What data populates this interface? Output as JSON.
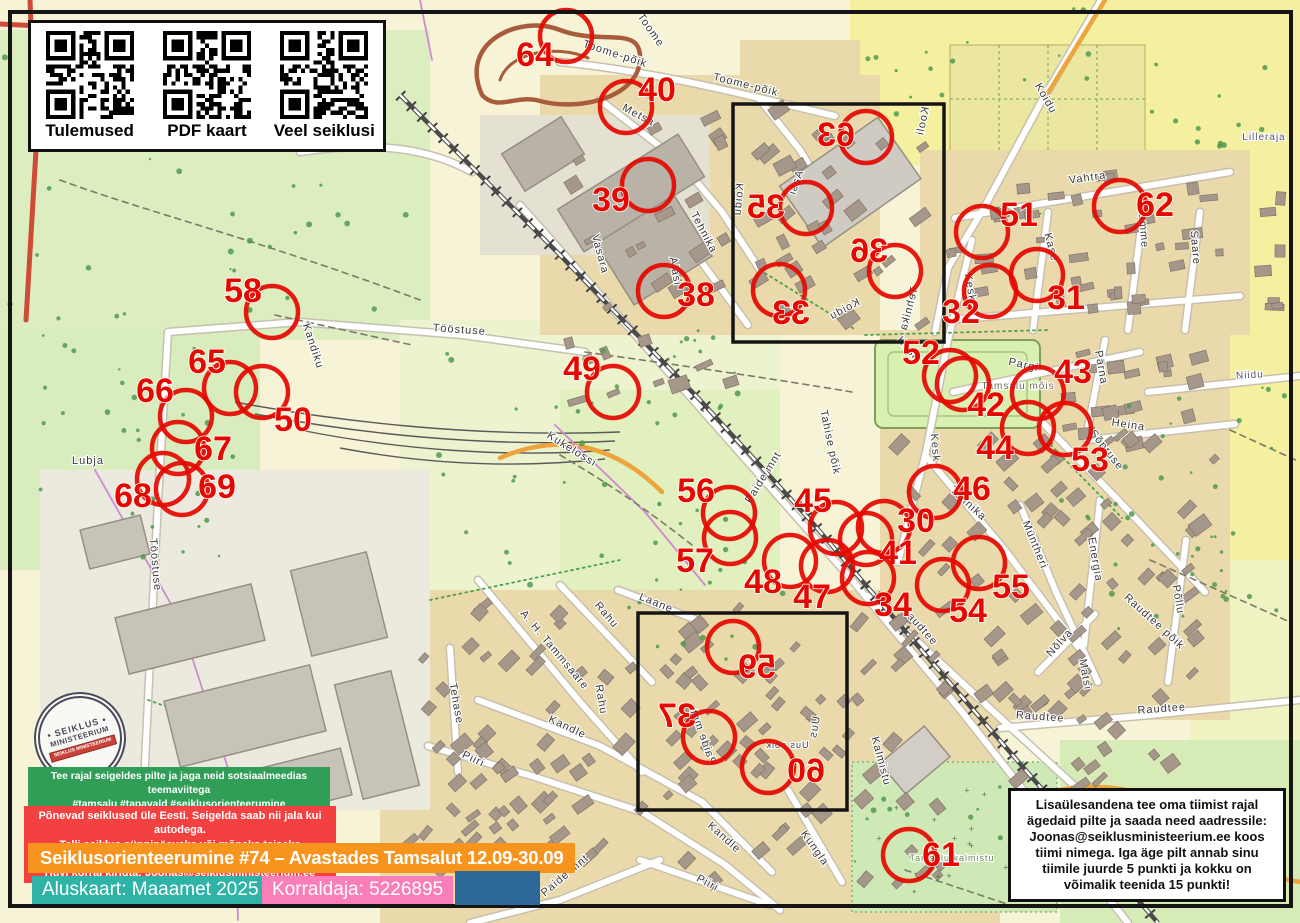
{
  "qr_panel": {
    "items": [
      {
        "label": "Tulemused",
        "color": "#56c462"
      },
      {
        "label": "PDF kaart",
        "color": "#f23d20"
      },
      {
        "label": "Veel seiklusi",
        "color": "#1d6fb8"
      }
    ]
  },
  "stamp": {
    "line1": "• SEIKLUS •",
    "line2": "MINISTEERIUM",
    "line3": "SEIKLUS MINISTEERIUM"
  },
  "social_box": {
    "line1": "Tee rajal seigeldes pilte ja jaga neid sotsiaalmeedias teemaviitega",
    "line2": "#tamsalu #tapavald #seiklusorienteerumine #seiklusministeerium"
  },
  "promo_box": {
    "line1": "Põnevad seiklused üle Eesti. Seigelda saab nii jala kui autodega.",
    "line2": "Telli seiklus sünnipäevaks või mõneks teiseks tähtpäevaks!",
    "line3": "Huvi korral kirjuta: Joonas@seiklusministeerium.ee"
  },
  "title_bar": "Seiklusorienteerumine #74 – Avastades Tamsalut 12.09-30.09",
  "base_bar": "Aluskaart: Maaamet 2025",
  "org_bar": "Korraldaja: 5226895",
  "note_box": "Lisaülesandena tee oma tiimist rajal ägedaid pilte ja saada need aadressile: Joonas@seiklusministeerium.ee koos tiimi nimega. Iga äge pilt annab sinu tiimile juurde 5 punkti ja kokku on võimalik teenida 15 punkti!",
  "map": {
    "control_color": "#e50800",
    "controls": [
      {
        "n": "64",
        "x": 566,
        "y": 36,
        "lx": 535,
        "ly": 57
      },
      {
        "n": "40",
        "x": 626,
        "y": 107,
        "lx": 657,
        "ly": 92
      },
      {
        "n": "39",
        "x": 648,
        "y": 185,
        "lx": 611,
        "ly": 202
      },
      {
        "n": "63",
        "x": 866,
        "y": 137,
        "lx": 836,
        "ly": 137,
        "m": 1
      },
      {
        "n": "35",
        "x": 806,
        "y": 208,
        "lx": 766,
        "ly": 209,
        "m": 1
      },
      {
        "n": "36",
        "x": 895,
        "y": 271,
        "lx": 869,
        "ly": 253,
        "m": 1
      },
      {
        "n": "33",
        "x": 779,
        "y": 290,
        "lx": 791,
        "ly": 315,
        "m": 1
      },
      {
        "n": "51",
        "x": 982,
        "y": 232,
        "lx": 1019,
        "ly": 217
      },
      {
        "n": "62",
        "x": 1120,
        "y": 206,
        "lx": 1155,
        "ly": 207
      },
      {
        "n": "58",
        "x": 272,
        "y": 312,
        "lx": 243,
        "ly": 293
      },
      {
        "n": "38",
        "x": 664,
        "y": 291,
        "lx": 696,
        "ly": 297
      },
      {
        "n": "32",
        "x": 990,
        "y": 291,
        "lx": 961,
        "ly": 314
      },
      {
        "n": "31",
        "x": 1037,
        "y": 275,
        "lx": 1066,
        "ly": 300
      },
      {
        "n": "65",
        "x": 230,
        "y": 388,
        "lx": 207,
        "ly": 364
      },
      {
        "n": "50",
        "x": 262,
        "y": 392,
        "lx": 293,
        "ly": 422
      },
      {
        "n": "66",
        "x": 186,
        "y": 416,
        "lx": 155,
        "ly": 393
      },
      {
        "n": "67",
        "x": 178,
        "y": 448,
        "lx": 213,
        "ly": 451
      },
      {
        "n": "68",
        "x": 163,
        "y": 479,
        "lx": 133,
        "ly": 498
      },
      {
        "n": "69",
        "x": 182,
        "y": 489,
        "lx": 217,
        "ly": 489
      },
      {
        "n": "49",
        "x": 613,
        "y": 392,
        "lx": 582,
        "ly": 371
      },
      {
        "n": "52",
        "x": 950,
        "y": 376,
        "lx": 921,
        "ly": 355
      },
      {
        "n": "42",
        "x": 963,
        "y": 384,
        "lx": 986,
        "ly": 407
      },
      {
        "n": "43",
        "x": 1038,
        "y": 393,
        "lx": 1073,
        "ly": 374
      },
      {
        "n": "44",
        "x": 1028,
        "y": 428,
        "lx": 995,
        "ly": 450
      },
      {
        "n": "53",
        "x": 1065,
        "y": 429,
        "lx": 1090,
        "ly": 462
      },
      {
        "n": "46",
        "x": 935,
        "y": 492,
        "lx": 972,
        "ly": 491
      },
      {
        "n": "56",
        "x": 729,
        "y": 513,
        "lx": 696,
        "ly": 493
      },
      {
        "n": "57",
        "x": 730,
        "y": 538,
        "lx": 695,
        "ly": 563
      },
      {
        "n": "45",
        "x": 836,
        "y": 528,
        "lx": 813,
        "ly": 503
      },
      {
        "n": "30",
        "x": 884,
        "y": 527,
        "lx": 916,
        "ly": 523
      },
      {
        "n": "41",
        "x": 866,
        "y": 539,
        "lx": 898,
        "ly": 555
      },
      {
        "n": "48",
        "x": 790,
        "y": 561,
        "lx": 763,
        "ly": 584
      },
      {
        "n": "47",
        "x": 827,
        "y": 566,
        "lx": 812,
        "ly": 599
      },
      {
        "n": "34",
        "x": 868,
        "y": 578,
        "lx": 893,
        "ly": 607
      },
      {
        "n": "55",
        "x": 979,
        "y": 563,
        "lx": 1011,
        "ly": 589
      },
      {
        "n": "54",
        "x": 943,
        "y": 585,
        "lx": 968,
        "ly": 613
      },
      {
        "n": "59",
        "x": 733,
        "y": 647,
        "lx": 757,
        "ly": 669,
        "m": 1
      },
      {
        "n": "37",
        "x": 709,
        "y": 737,
        "lx": 677,
        "ly": 718,
        "m": 1
      },
      {
        "n": "60",
        "x": 768,
        "y": 767,
        "lx": 806,
        "ly": 773,
        "m": 1
      },
      {
        "n": "61",
        "x": 909,
        "y": 855,
        "lx": 941,
        "ly": 857
      }
    ],
    "street_labels": [
      {
        "t": "Toome",
        "x": 648,
        "y": 32,
        "r": 55
      },
      {
        "t": "Toome-põik",
        "x": 614,
        "y": 57,
        "r": 18
      },
      {
        "t": "Toome-põik",
        "x": 745,
        "y": 88,
        "r": 14
      },
      {
        "t": "Metsa",
        "x": 637,
        "y": 118,
        "r": 28
      },
      {
        "t": "Tehnika",
        "x": 701,
        "y": 234,
        "r": 62
      },
      {
        "t": "Vasara",
        "x": 597,
        "y": 255,
        "r": 75
      },
      {
        "t": "Alasi",
        "x": 672,
        "y": 272,
        "r": 80
      },
      {
        "t": "Koidu",
        "x": 1043,
        "y": 100,
        "r": 60
      },
      {
        "t": "Vahtra",
        "x": 1088,
        "y": 181,
        "r": -8
      },
      {
        "t": "Kase",
        "x": 1048,
        "y": 248,
        "r": 75
      },
      {
        "t": "Tamme",
        "x": 1140,
        "y": 228,
        "r": 85
      },
      {
        "t": "Saare",
        "x": 1192,
        "y": 248,
        "r": 85
      },
      {
        "t": "Lilleraja",
        "x": 1264,
        "y": 140,
        "r": 0,
        "s": 10,
        "c": "#555577"
      },
      {
        "t": "Kooli",
        "x": 926,
        "y": 122,
        "r": 78,
        "m": 1
      },
      {
        "t": "Aasi",
        "x": 799,
        "y": 184,
        "r": 70,
        "m": 1
      },
      {
        "t": "Koidu",
        "x": 742,
        "y": 200,
        "r": 85,
        "m": 1
      },
      {
        "t": "Koidu",
        "x": 846,
        "y": 312,
        "r": 28,
        "m": 1
      },
      {
        "t": "Tehnika",
        "x": 912,
        "y": 310,
        "r": 75,
        "m": 1
      },
      {
        "t": "Kesk",
        "x": 967,
        "y": 288,
        "r": 80
      },
      {
        "t": "Kesk",
        "x": 906,
        "y": 351,
        "r": 48
      },
      {
        "t": "Kesk",
        "x": 932,
        "y": 448,
        "r": 85
      },
      {
        "t": "Pargi",
        "x": 1023,
        "y": 368,
        "r": 12
      },
      {
        "t": "Tamsalu mõis",
        "x": 1018,
        "y": 389,
        "r": 0,
        "s": 10,
        "c": "#6b6b5a"
      },
      {
        "t": "Pärna",
        "x": 1098,
        "y": 368,
        "r": 80
      },
      {
        "t": "Heina",
        "x": 1128,
        "y": 428,
        "r": 8
      },
      {
        "t": "Sõpruse",
        "x": 1104,
        "y": 452,
        "r": 52
      },
      {
        "t": "Niidu",
        "x": 1250,
        "y": 378,
        "r": -3,
        "s": 10,
        "c": "#555577"
      },
      {
        "t": "Tahise põik",
        "x": 827,
        "y": 443,
        "r": 78
      },
      {
        "t": "Tehnika",
        "x": 966,
        "y": 506,
        "r": 42
      },
      {
        "t": "Müntheri",
        "x": 1032,
        "y": 546,
        "r": 68
      },
      {
        "t": "Energia",
        "x": 1092,
        "y": 560,
        "r": 80
      },
      {
        "t": "Põllu",
        "x": 1175,
        "y": 600,
        "r": 80
      },
      {
        "t": "Raudtee",
        "x": 917,
        "y": 628,
        "r": 48
      },
      {
        "t": "Raudtee põik",
        "x": 1152,
        "y": 624,
        "r": 42
      },
      {
        "t": "Raudtee",
        "x": 1040,
        "y": 720,
        "r": 4
      },
      {
        "t": "Raudtee",
        "x": 1162,
        "y": 712,
        "r": -4
      },
      {
        "t": "Nõlva",
        "x": 1062,
        "y": 645,
        "r": -48
      },
      {
        "t": "Matsi",
        "x": 1082,
        "y": 675,
        "r": 80
      },
      {
        "t": "Kalmistu",
        "x": 878,
        "y": 762,
        "r": 75
      },
      {
        "t": "Tamsalu kalmistu",
        "x": 952,
        "y": 861,
        "r": 0,
        "s": 9,
        "c": "#6a8a57"
      },
      {
        "t": "A. H. Tammsaare",
        "x": 552,
        "y": 652,
        "r": 50
      },
      {
        "t": "Rahu",
        "x": 604,
        "y": 617,
        "r": 50
      },
      {
        "t": "Kandle",
        "x": 566,
        "y": 730,
        "r": 25
      },
      {
        "t": "Kandle",
        "x": 722,
        "y": 840,
        "r": 42
      },
      {
        "t": "Piiri",
        "x": 472,
        "y": 762,
        "r": 25
      },
      {
        "t": "Piiri",
        "x": 706,
        "y": 886,
        "r": 28
      },
      {
        "t": "Tehase",
        "x": 453,
        "y": 704,
        "r": 80
      },
      {
        "t": "Kungla",
        "x": 812,
        "y": 850,
        "r": 55
      },
      {
        "t": "Laane",
        "x": 655,
        "y": 606,
        "r": 22
      },
      {
        "t": "Uus",
        "x": 818,
        "y": 728,
        "r": 80,
        "m": 1
      },
      {
        "t": "Uus põik",
        "x": 787,
        "y": 748,
        "r": 0,
        "m": 1,
        "s": 9
      },
      {
        "t": "Paide mnt",
        "x": 766,
        "y": 479,
        "r": -58
      },
      {
        "t": "Paide mnt",
        "x": 700,
        "y": 738,
        "r": -70,
        "m": 1
      },
      {
        "t": "Paide mnt",
        "x": 567,
        "y": 878,
        "r": -40
      },
      {
        "t": "Lubja",
        "x": 88,
        "y": 464,
        "r": 0
      },
      {
        "t": "Tööstuse",
        "x": 459,
        "y": 333,
        "r": 4
      },
      {
        "t": "Tööstuse",
        "x": 152,
        "y": 565,
        "r": 85
      },
      {
        "t": "Kandiku",
        "x": 310,
        "y": 347,
        "r": 72
      },
      {
        "t": "Kukelossi",
        "x": 570,
        "y": 452,
        "r": 32
      },
      {
        "t": "Rahu",
        "x": 598,
        "y": 700,
        "r": 80
      }
    ],
    "insets": [
      {
        "x": 733,
        "y": 104,
        "w": 211,
        "h": 238
      },
      {
        "x": 638,
        "y": 613,
        "w": 209,
        "h": 197
      }
    ]
  }
}
